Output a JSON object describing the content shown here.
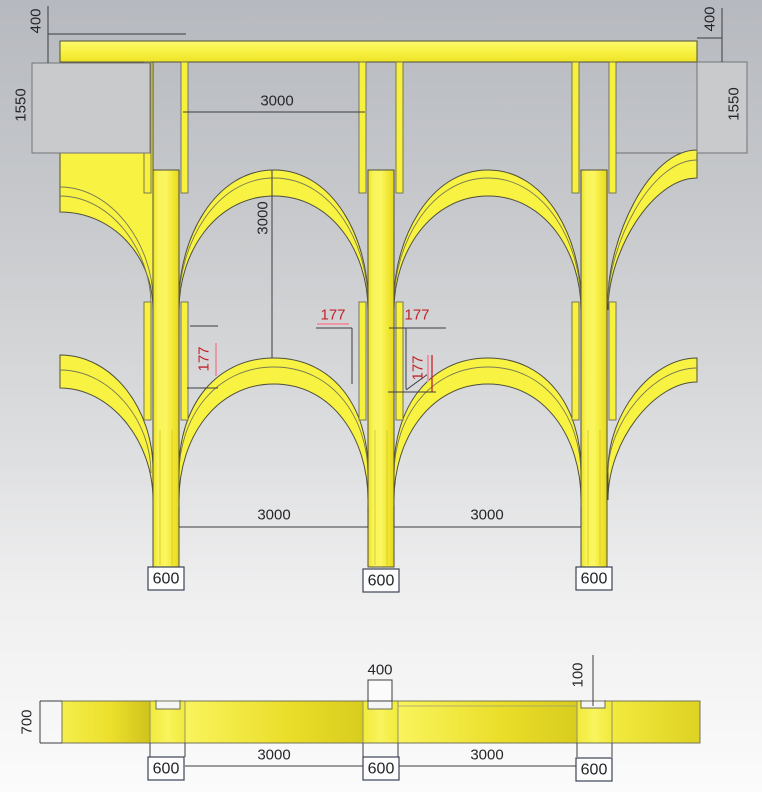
{
  "front_view": {
    "dims": {
      "beam_height_left": "400",
      "beam_height_right": "400",
      "end_wall_left": "1550",
      "end_wall_right": "1550",
      "top_span": "3000",
      "story_height": "3000",
      "arch_offset_1": "177",
      "arch_offset_2": "177",
      "arch_offset_3": "177",
      "arch_offset_4": "177",
      "bottom_span_left": "3000",
      "bottom_span_right": "3000",
      "column_width_1": "600",
      "column_width_2": "600",
      "column_width_3": "600"
    }
  },
  "section_view": {
    "dims": {
      "depth": "700",
      "notch_width": "400",
      "notch_depth": "100",
      "span_left": "3000",
      "span_right": "3000",
      "column_width_1": "600",
      "column_width_2": "600",
      "column_width_3": "600"
    }
  },
  "colors": {
    "structure_yellow": "#f8f243",
    "outline": "#4f4f3c",
    "dimension_text": "#26272b",
    "offset_red": "#c4232b",
    "offset_pink": "#eb97a6",
    "end_wall_grey": "#c9cacc",
    "background_top": "#b6b9bf",
    "background_bottom": "#fbfbfb"
  }
}
